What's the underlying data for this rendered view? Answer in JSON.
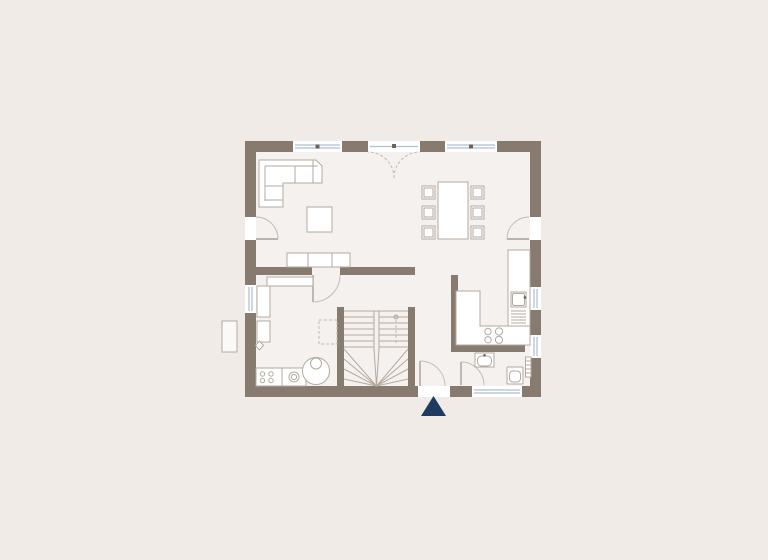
{
  "app": {
    "type": "floor-plan-viewer",
    "content": "architectural ground floor plan, no text labels rendered"
  },
  "colors": {
    "canvas-bg": "#f0ebe7",
    "floor": "#f5f1ee",
    "wall": "#877b6f",
    "fixture-fill": "#ffffff",
    "fixture-stroke": "#b3aaa0",
    "glass": "#aebfd0",
    "window-dot": "#6e6457",
    "swing": "#c6bdb3",
    "door-leaf": "#a89f95",
    "dashed": "#c3bab0",
    "stair": "#b3aaa0",
    "entrance-marker": "#1f3a60",
    "shaft-fill": "#fbf9f8"
  },
  "plan": {
    "outer_bounds_px": {
      "x": 245,
      "y": 141,
      "width": 296,
      "height": 256
    },
    "wall_thickness_px": 11,
    "areas": [
      "living-area",
      "dining-area",
      "kitchen",
      "hall",
      "wc",
      "utility-room",
      "stairwell"
    ],
    "openings": {
      "top_wall": [
        "window",
        "double-french-door",
        "window"
      ],
      "left_wall": [
        "terrace-door",
        "window"
      ],
      "right_wall": [
        "terrace-door",
        "kitchen-window",
        "small-window"
      ],
      "bottom_wall": [
        "entrance-door",
        "wc-window"
      ]
    },
    "fixtures": [
      "corner-sofa",
      "coffee-table",
      "sideboard",
      "utility-shelf",
      "dining-table",
      "dining-chair",
      "kitchen-counter-right",
      "kitchen-sink",
      "kitchen-counter-l",
      "cooktop",
      "wc-washbasin",
      "wc-toilet",
      "wc-radiator",
      "utility-cabinet",
      "appliance-dryer",
      "appliance-washer",
      "boiler-tank",
      "planned-item-dashed",
      "light-shaft",
      "stairs-u-winder"
    ],
    "counts": {
      "dining_chairs": 6,
      "cooktop_burners": 4,
      "washer_dots": 4
    },
    "stairs": {
      "type": "u-shaped-winder",
      "flights": 2,
      "winder_fan": true
    },
    "entrance_marker": {
      "shape": "triangle-up",
      "color": "#1f3a60"
    }
  }
}
